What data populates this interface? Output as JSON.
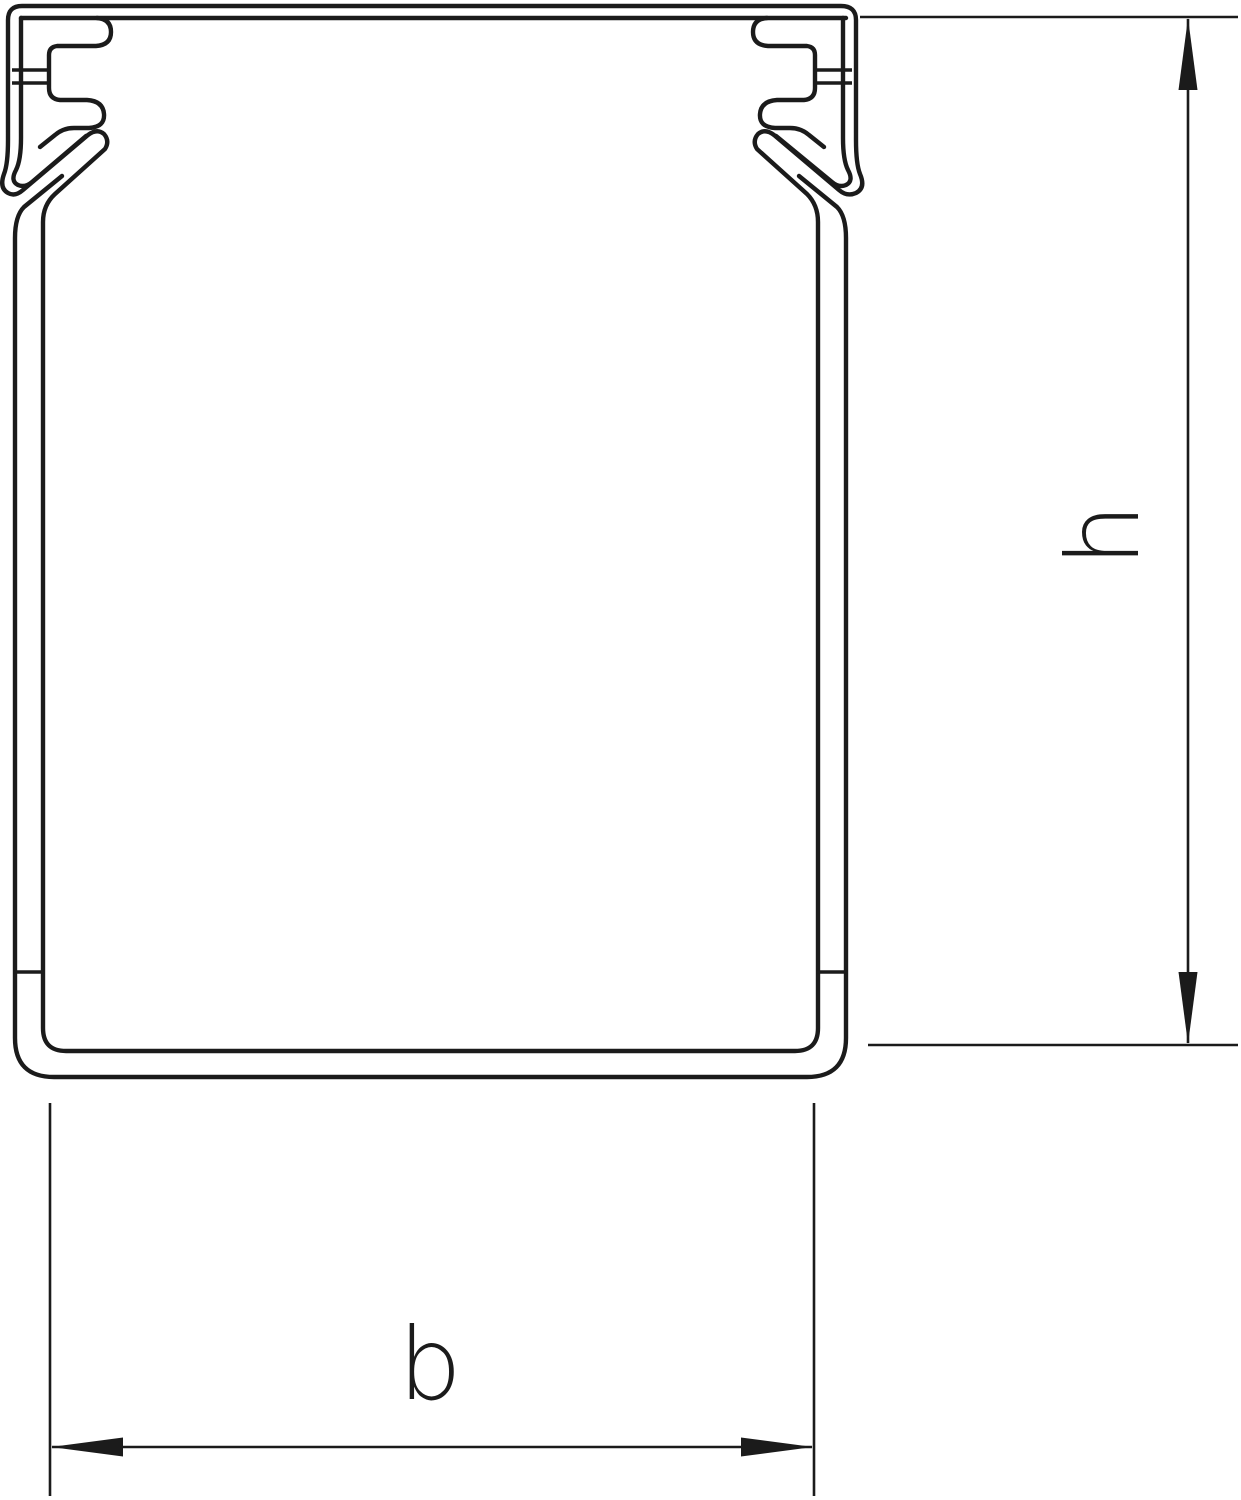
{
  "page": {
    "background_color": "#ffffff",
    "line_color": "#1b1b1b"
  },
  "drawing": {
    "kind": "cable-duct cross-section dimension drawing",
    "labels": {
      "height": "h",
      "width": "b"
    }
  }
}
